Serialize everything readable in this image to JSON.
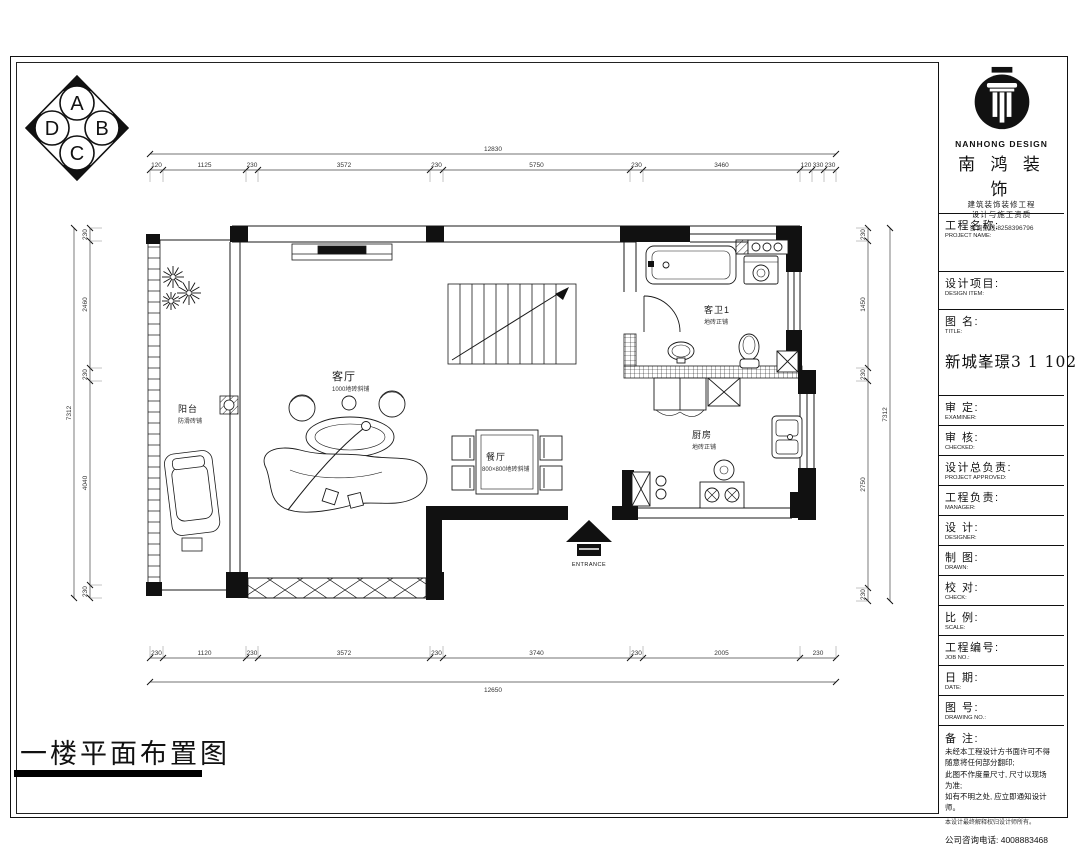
{
  "sheet": {
    "title": "一楼平面布置图",
    "compass": {
      "letters": [
        "A",
        "B",
        "C",
        "D"
      ]
    }
  },
  "plan": {
    "rooms": {
      "living": {
        "name": "客厅",
        "finish": "1000地砖斜铺"
      },
      "dining": {
        "name": "餐厅",
        "finish": "800×800地砖斜铺"
      },
      "kitchen": {
        "name": "厨房",
        "finish": "地砖正铺"
      },
      "bath": {
        "name": "客卫1",
        "finish": "地砖正铺"
      },
      "balcony": {
        "name": "阳台",
        "finish": "防滑砖铺"
      },
      "entrance": {
        "name": "ENTRANCE"
      }
    },
    "dimensions": {
      "top_total": "12830",
      "top_segments": [
        "120",
        "1125",
        "230",
        "3572",
        "230",
        "5750",
        "230",
        "3460",
        "120",
        "330",
        "230"
      ],
      "bottom_total": "12650",
      "bottom_segments": [
        "230",
        "1120",
        "230",
        "3572",
        "230",
        "3740",
        "230",
        "2005",
        "230"
      ],
      "left_total": "7312",
      "left_segments": [
        "230",
        "2460",
        "230",
        "4040",
        "230"
      ],
      "right_total": "7312",
      "right_segments": [
        "230",
        "1450",
        "230",
        "2750",
        "230"
      ]
    }
  },
  "title_block": {
    "brand_en": "NANHONG DESIGN",
    "brand_cn": "南 鸿 装 饰",
    "tagline1": "建筑装饰装修工程",
    "tagline2": "设计与施工资质",
    "tagline3": "咨询热线:8258396796",
    "project_title": "新城峯璟3 1 102",
    "fields": [
      {
        "cn": "工程名称:",
        "en": "PROJECT NAME:"
      },
      {
        "cn": "设计项目:",
        "en": "DESIGN ITEM:"
      },
      {
        "cn": "图  名:",
        "en": "TITLE:"
      },
      {
        "cn": "审  定:",
        "en": "EXAMINER:"
      },
      {
        "cn": "审  核:",
        "en": "CHECKED:"
      },
      {
        "cn": "设计总负责:",
        "en": "PROJECT APPROVED:"
      },
      {
        "cn": "工程负责:",
        "en": "MANAGER:"
      },
      {
        "cn": "设  计:",
        "en": "DESIGNER:"
      },
      {
        "cn": "制  图:",
        "en": "DRAWN:"
      },
      {
        "cn": "校  对:",
        "en": "CHECK:"
      },
      {
        "cn": "比  例:",
        "en": "SCALE:"
      },
      {
        "cn": "工程编号:",
        "en": "JOB NO.:"
      },
      {
        "cn": "日  期:",
        "en": "DATE:"
      },
      {
        "cn": "图  号:",
        "en": "DRAWING NO.:"
      }
    ],
    "notes": {
      "label": "备  注:",
      "lines": [
        "未经本工程设计方书面许可不得",
        "随意将任何部分翻印;",
        "此图不作度量尺寸, 尺寸以现场",
        "为准;",
        "如有不明之处, 应立即通知设计",
        "师。"
      ],
      "small": "本设计最终解释权归设计师所有。",
      "phone": "公司咨询电话: 4008883468"
    }
  }
}
